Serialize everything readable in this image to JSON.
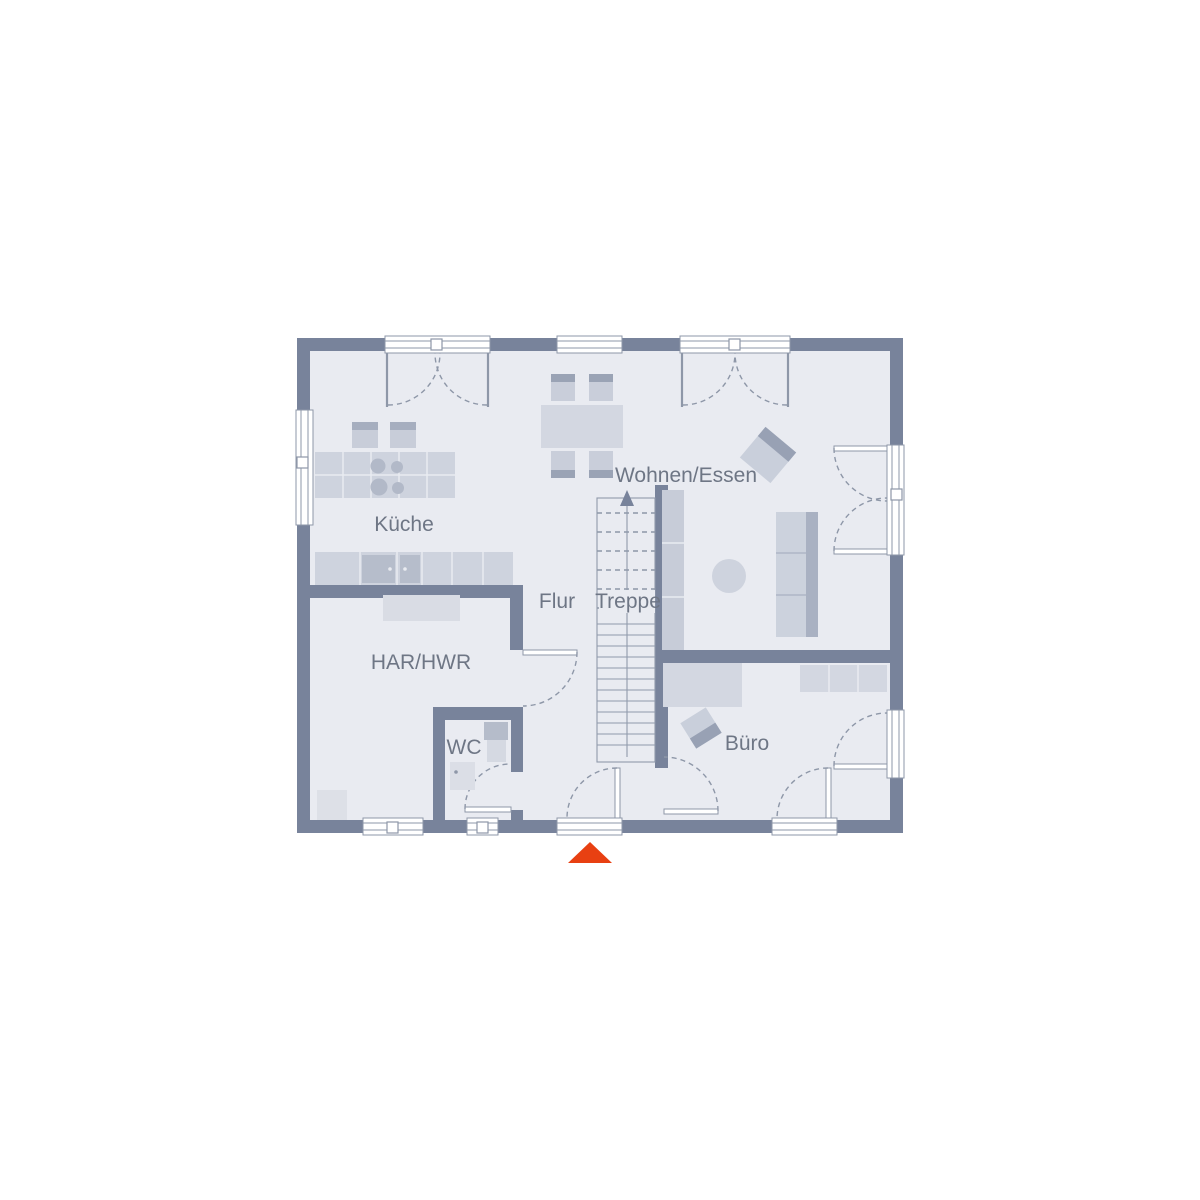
{
  "plan": {
    "type": "floor-plan",
    "rooms": {
      "kueche": "Küche",
      "wohnen_essen": "Wohnen/Essen",
      "flur": "Flur",
      "treppe": "Treppe",
      "har_hwr": "HAR/HWR",
      "wc": "WC",
      "buero": "Büro"
    },
    "icons": {
      "entrance_marker": "triangle-up",
      "stairs_direction": "arrow-up"
    },
    "colors": {
      "background": "#ffffff",
      "wall": "#78839b",
      "floor": "#e9ebf1",
      "outline": "#8e97a8",
      "furniture_light": "#d3d7e1",
      "furniture_mid": "#c8cdd9",
      "furniture_dark": "#9aa3b5",
      "appliance": "#b6bdcb",
      "label_text": "#6e7685",
      "entrance_marker": "#e84012"
    }
  },
  "rooms": {
    "kueche": "Küche",
    "wohnen_essen": "Wohnen/Essen",
    "flur": "Flur",
    "treppe": "Treppe",
    "har_hwr": "HAR/HWR",
    "wc": "WC",
    "buero": "Büro"
  }
}
